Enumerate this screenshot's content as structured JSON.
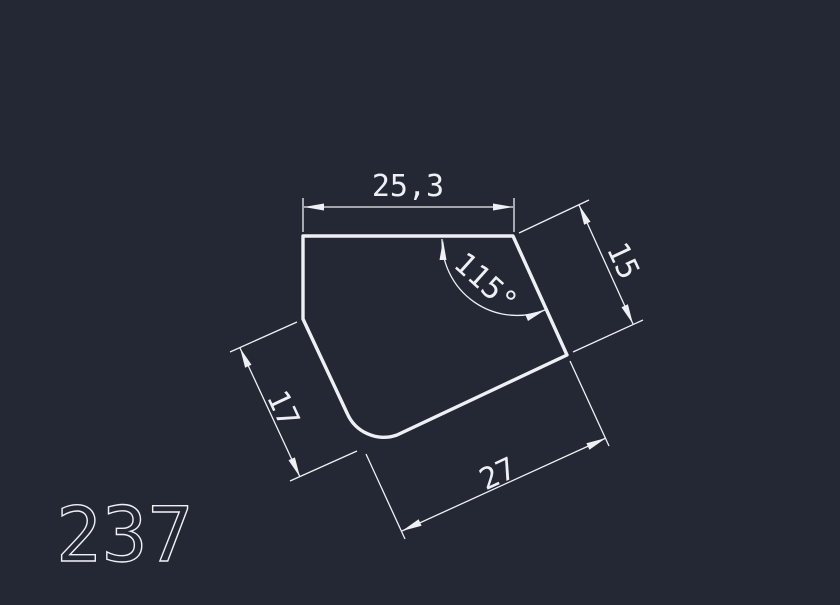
{
  "colors": {
    "background": "#232834",
    "line": "#eef1f4"
  },
  "part_label": "237",
  "dims": {
    "top_width": {
      "label": "25,3",
      "value": 25.3
    },
    "angle": {
      "label": "115°",
      "value": 115
    },
    "right_side": {
      "label": "15",
      "value": 15
    },
    "left_side": {
      "label": "17",
      "value": 17
    },
    "bottom_side": {
      "label": "27",
      "value": 27
    }
  }
}
